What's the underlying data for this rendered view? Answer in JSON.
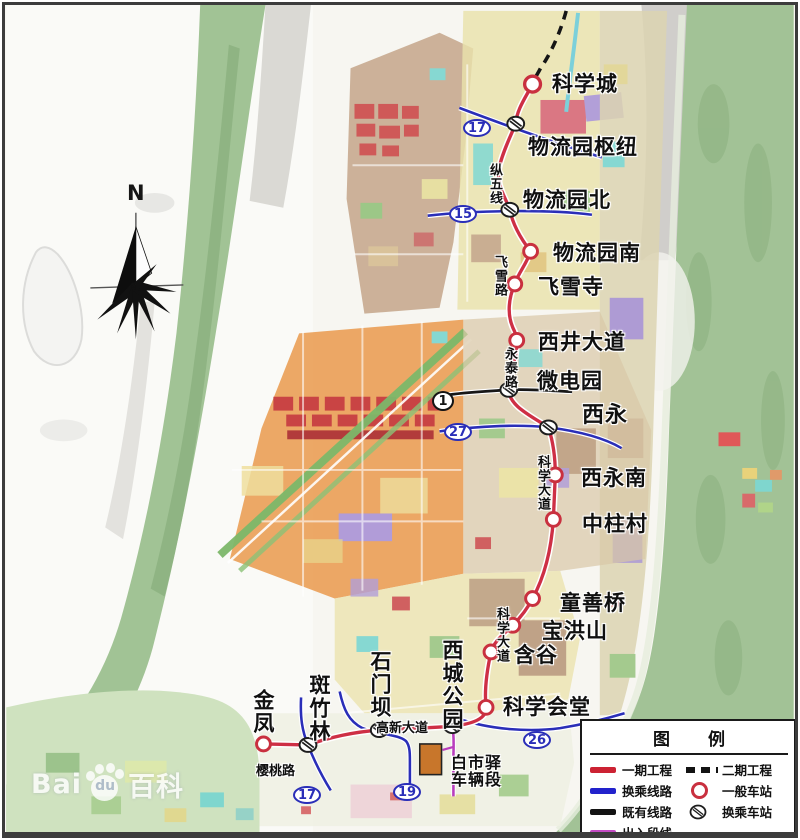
{
  "watermark": {
    "part1": "Bai",
    "part2": "du",
    "part3": "百科"
  },
  "compass": {
    "north_label": "N"
  },
  "stations": [
    {
      "name": "科学城",
      "type": "regular"
    },
    {
      "name": "物流园枢纽",
      "type": "transfer"
    },
    {
      "name": "物流园北",
      "type": "transfer"
    },
    {
      "name": "物流园南",
      "type": "regular"
    },
    {
      "name": "飞雪寺",
      "type": "regular"
    },
    {
      "name": "西井大道",
      "type": "regular"
    },
    {
      "name": "微电园",
      "type": "transfer"
    },
    {
      "name": "西永",
      "type": "transfer"
    },
    {
      "name": "西永南",
      "type": "regular"
    },
    {
      "name": "中柱村",
      "type": "regular"
    },
    {
      "name": "童善桥",
      "type": "regular"
    },
    {
      "name": "宝洪山",
      "type": "regular"
    },
    {
      "name": "含谷",
      "type": "regular"
    },
    {
      "name": "科学会堂",
      "type": "regular"
    },
    {
      "name": "西城公园",
      "type": "transfer"
    },
    {
      "name": "石门坝",
      "type": "transfer"
    },
    {
      "name": "斑竹林",
      "type": "transfer"
    },
    {
      "name": "金凤",
      "type": "regular"
    }
  ],
  "depot": {
    "name_line1": "白市驿",
    "name_line2": "车辆段"
  },
  "roads": [
    {
      "name": "纵五线"
    },
    {
      "name": "飞雪路"
    },
    {
      "name": "永泰路"
    },
    {
      "name": "科学大道"
    },
    {
      "name": "科学大道"
    },
    {
      "name": "高新大道"
    },
    {
      "name": "樱桃路"
    }
  ],
  "line_badges": [
    {
      "number": "17",
      "style": "blue"
    },
    {
      "number": "15",
      "style": "blue"
    },
    {
      "number": "1",
      "style": "black"
    },
    {
      "number": "27",
      "style": "blue"
    },
    {
      "number": "26",
      "style": "blue"
    },
    {
      "number": "19",
      "style": "blue"
    },
    {
      "number": "17",
      "style": "blue"
    }
  ],
  "legend": {
    "title_char1": "图",
    "title_char2": "例",
    "items_left": [
      {
        "label": "一期工程",
        "swatch": "red-line"
      },
      {
        "label": "换乘线路",
        "swatch": "blue-line"
      },
      {
        "label": "既有线路",
        "swatch": "black-line"
      },
      {
        "label": "出入段线",
        "swatch": "magenta-line"
      }
    ],
    "items_right": [
      {
        "label": "二期工程",
        "swatch": "black-dashed"
      },
      {
        "label": "一般车站",
        "swatch": "station-circle"
      },
      {
        "label": "换乘车站",
        "swatch": "transfer-circle"
      }
    ]
  },
  "colors": {
    "phase1_line": "#ce2f45",
    "phase2_line": "#151515",
    "transfer_line": "#2a2eb8",
    "existing_line": "#171717",
    "depot_entry_line": "#b93dbd",
    "station_ring": "#c9303f"
  }
}
